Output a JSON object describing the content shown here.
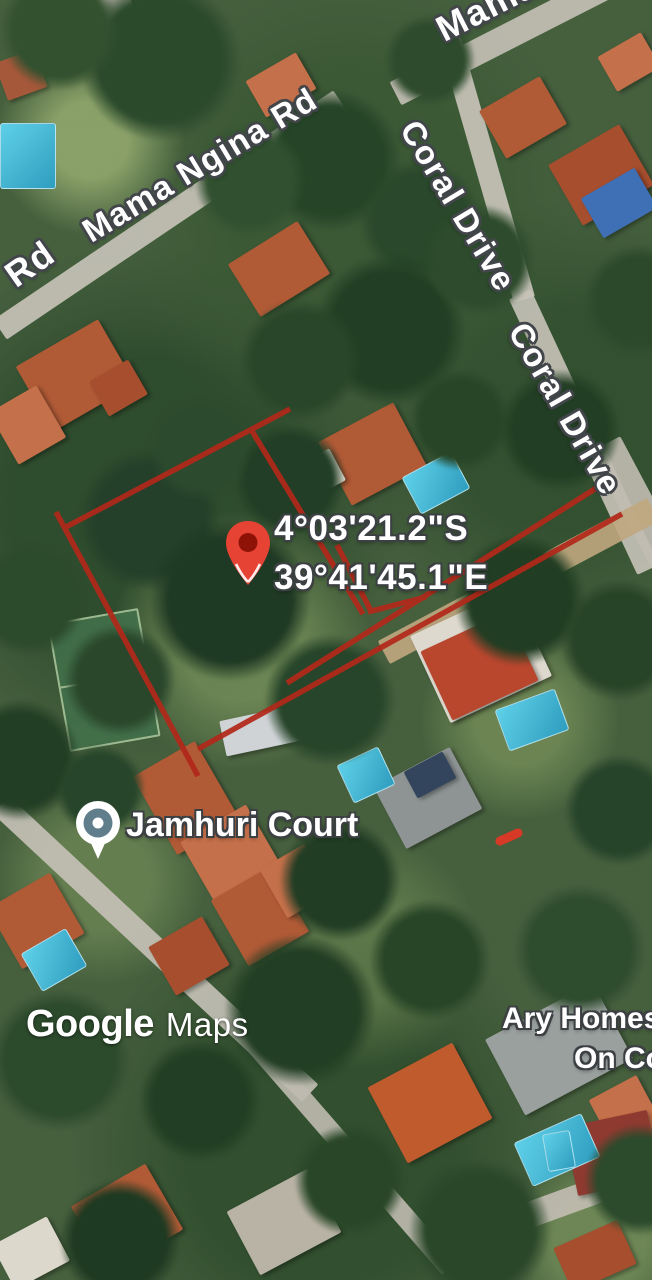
{
  "map": {
    "type": "satellite",
    "road_labels": [
      {
        "id": "rd-partial",
        "text": "Rd"
      },
      {
        "id": "mama-ngina-rd",
        "text": "Mama Ngina Rd"
      },
      {
        "id": "mama-top-right",
        "text": "Mama"
      },
      {
        "id": "coral-drive-upper",
        "text": "Coral Drive"
      },
      {
        "id": "coral-drive-lower",
        "text": "Coral Drive"
      }
    ],
    "place_labels": {
      "jamhuri_court": "Jamhuri Court",
      "ary_homes_line1": "Ary Homes",
      "ary_homes_line2": "On Co"
    },
    "dropped_pin": {
      "coordinates_line1": "4°03'21.2\"S",
      "coordinates_line2": "39°41'45.1\"E",
      "pin_color": "#E64335",
      "pin_inner_color": "#8E1206"
    },
    "poi_pin_color": "#607D8B",
    "annotation": {
      "description": "hand-drawn red plot boundary and measurement lines",
      "line_color": "#B2281A",
      "dash_color": "#D63A26"
    },
    "watermark": {
      "brand": "Google",
      "product": "Maps"
    }
  }
}
